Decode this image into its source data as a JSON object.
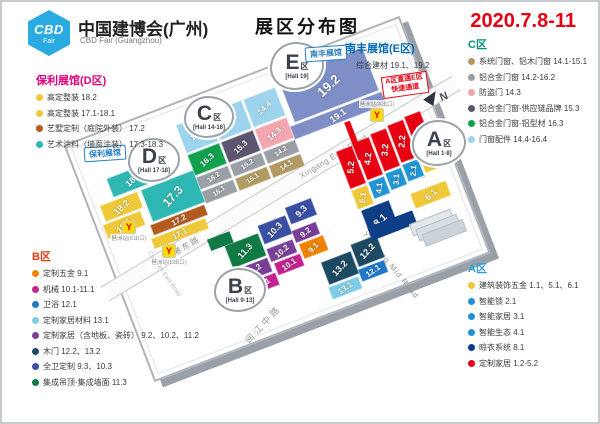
{
  "header": {
    "logo": {
      "line1": "CBD",
      "line2": "Fair"
    },
    "brand_cn": "中国建博会(广州)",
    "brand_en": "CBD Fair (Guangzhou)",
    "page_title": "展区分布图",
    "date": "2020.7.8-11",
    "date_color": "#e60012"
  },
  "legends": {
    "d": {
      "title": "保利展馆(D区)",
      "title_color": "#e5007e",
      "items": [
        {
          "dot": "#f0c93a",
          "label": "高定整装 18.2"
        },
        {
          "dot": "#f0c93a",
          "label": "高定整装 17.1-18.1"
        },
        {
          "dot": "#b35a1f",
          "label": "艺墅定制（庭院外装） 17.2"
        },
        {
          "dot": "#2fb8b3",
          "label": "艺术涂料（墙面涂装） 17.3-18.3"
        }
      ]
    },
    "e": {
      "title": "南丰展馆(E区)",
      "title_color": "#0068b7",
      "items": [
        {
          "dot": "#7e8ec6",
          "label": "综合建材 19.1、19.2"
        }
      ]
    },
    "c": {
      "title": "C区",
      "title_color": "#00917c",
      "items": [
        {
          "dot": "#b39a63",
          "label": "系统门窗、铝木门窗 14.1-15.1"
        },
        {
          "dot": "#9aa0a6",
          "label": "铝合金门窗 14.2-16.2"
        },
        {
          "dot": "#f2a7b0",
          "label": "防盗门 14.3"
        },
        {
          "dot": "#5c5470",
          "label": "铝合金门窗-供应链品牌 15.3"
        },
        {
          "dot": "#12a04e",
          "label": "铝合金门窗-铝型材 16.3"
        },
        {
          "dot": "#9fd4ee",
          "label": "门窗配件 14.4-16.4"
        }
      ]
    },
    "a": {
      "title": "A区",
      "title_color": "#2a9fdc",
      "items": [
        {
          "dot": "#f0c93a",
          "label": "建筑装饰五金 1.1、5.1、6.1"
        },
        {
          "dot": "#1e90d6",
          "label": "智能锁 2.1"
        },
        {
          "dot": "#1e90d6",
          "label": "智能家居 3.1"
        },
        {
          "dot": "#1e90d6",
          "label": "智能生态 4.1"
        },
        {
          "dot": "#0b3c8c",
          "label": "晾衣系统 8.1"
        },
        {
          "dot": "#e60012",
          "label": "定制家居 1.2-5.2"
        }
      ]
    },
    "b": {
      "title": "B区",
      "title_color": "#e8380d",
      "items": [
        {
          "dot": "#ef8200",
          "label": "定制五金 9.1"
        },
        {
          "dot": "#c4228f",
          "label": "机械 10.1-11.1"
        },
        {
          "dot": "#1f78c8",
          "label": "卫浴 12.1"
        },
        {
          "dot": "#7ecde8",
          "label": "定制家居材料 13.1"
        },
        {
          "dot": "#7a3f98",
          "label": "定制家居（含地板、瓷砖） 9.2、10.2、11.2"
        },
        {
          "dot": "#1d4a63",
          "label": "木门 12.2、13.2"
        },
        {
          "dot": "#3a4fa3",
          "label": "全卫定制 9.3、10.3"
        },
        {
          "dot": "#0f7a43",
          "label": "集成吊顶·集成墙面 11.3"
        }
      ]
    }
  },
  "map": {
    "clouds": [
      {
        "id": "e",
        "letter": "E",
        "qu": "区",
        "hall": "[Hall 19]"
      },
      {
        "id": "c",
        "letter": "C",
        "qu": "区",
        "hall": "[Hall 14-16]"
      },
      {
        "id": "d",
        "letter": "D",
        "qu": "区",
        "hall": "[Hall 17-18]"
      },
      {
        "id": "b",
        "letter": "B",
        "qu": "区",
        "hall": "[Hall 9-13]"
      },
      {
        "id": "a",
        "letter": "A",
        "qu": "区",
        "hall": "[Hall 1-8]"
      }
    ],
    "tags": [
      {
        "id": "nanfeng",
        "label": "南丰展馆"
      },
      {
        "id": "poly",
        "label": "保利展馆"
      }
    ],
    "notice": {
      "line1": "A区直通E区",
      "line2": "快速通道"
    },
    "compass": "N",
    "roads": [
      {
        "id": "xingang-cn",
        "label": "新港东路"
      },
      {
        "id": "xingang-en",
        "label": "Xingang East Road"
      },
      {
        "id": "yuejiang-cn",
        "label": "阅江中路"
      },
      {
        "id": "yuejiang-en",
        "label": "Yuejiang Mid Road"
      },
      {
        "id": "complex-west",
        "label": "Complex West Road"
      },
      {
        "id": "complex-east",
        "label": "Complex East Road"
      }
    ],
    "metro_exits": [
      {
        "label": "琶洲站(A出口)"
      },
      {
        "label": "琶洲站(C出口)"
      },
      {
        "label": "琶洲站(D出口)"
      }
    ],
    "halls": [
      {
        "id": "19.2",
        "label": "19.2",
        "color": "#7e8ec6"
      },
      {
        "id": "19.1",
        "label": "19.1",
        "color": "#7e8ec6"
      },
      {
        "id": "16.4",
        "label": "16.4",
        "color": "#9fd4ee"
      },
      {
        "id": "15.4",
        "label": "15.4",
        "color": "#9fd4ee"
      },
      {
        "id": "14.4",
        "label": "14.4",
        "color": "#9fd4ee"
      },
      {
        "id": "16.3",
        "label": "16.3",
        "color": "#12a04e"
      },
      {
        "id": "15.3",
        "label": "15.3",
        "color": "#5c5470"
      },
      {
        "id": "14.3",
        "label": "14.3",
        "color": "#f2a7b0"
      },
      {
        "id": "16.2",
        "label": "16.2",
        "color": "#9aa0a6"
      },
      {
        "id": "15.2",
        "label": "15.2",
        "color": "#9aa0a6"
      },
      {
        "id": "14.2",
        "label": "14.2",
        "color": "#9aa0a6"
      },
      {
        "id": "16.1",
        "label": "16.1",
        "color": "#9aa0a6"
      },
      {
        "id": "15.1",
        "label": "15.1",
        "color": "#b39a63"
      },
      {
        "id": "14.1",
        "label": "14.1",
        "color": "#b39a63"
      },
      {
        "id": "18.3",
        "label": "18.3",
        "color": "#2fb8b3"
      },
      {
        "id": "18.2",
        "label": "18.2",
        "color": "#f0c93a"
      },
      {
        "id": "18.1",
        "label": "18.1",
        "color": "#f0c93a"
      },
      {
        "id": "17.3",
        "label": "17.3",
        "color": "#2fb8b3"
      },
      {
        "id": "17.2",
        "label": "17.2",
        "color": "#b35a1f"
      },
      {
        "id": "17.1",
        "label": "17.1",
        "color": "#f0c93a"
      },
      {
        "id": "5.2",
        "label": "5.2",
        "color": "#e60012"
      },
      {
        "id": "4.2",
        "label": "4.2",
        "color": "#e60012"
      },
      {
        "id": "3.2",
        "label": "3.2",
        "color": "#e60012"
      },
      {
        "id": "2.2",
        "label": "2.2",
        "color": "#e60012"
      },
      {
        "id": "1.2",
        "label": "1.2",
        "color": "#e60012"
      },
      {
        "id": "5.1",
        "label": "5.1",
        "color": "#f0c93a"
      },
      {
        "id": "4.1",
        "label": "4.1",
        "color": "#2196d4"
      },
      {
        "id": "3.1",
        "label": "3.1",
        "color": "#2196d4"
      },
      {
        "id": "2.1",
        "label": "2.1",
        "color": "#2196d4"
      },
      {
        "id": "1.1",
        "label": "1.1",
        "color": "#f0c93a"
      },
      {
        "id": "6.1",
        "label": "6.1",
        "color": "#f0c93a"
      },
      {
        "id": "8.1",
        "label": "8.1",
        "color": "#0e3f86"
      },
      {
        "id": "11.3",
        "label": "11.3",
        "color": "#0f7a43"
      },
      {
        "id": "10.3",
        "label": "10.3",
        "color": "#3a4fa3"
      },
      {
        "id": "9.3",
        "label": "9.3",
        "color": "#3a4fa3"
      },
      {
        "id": "11.2",
        "label": "11.2",
        "color": "#7a3f98"
      },
      {
        "id": "10.2",
        "label": "10.2",
        "color": "#7a3f98"
      },
      {
        "id": "9.2",
        "label": "9.2",
        "color": "#7a3f98"
      },
      {
        "id": "11.1",
        "label": "11.1",
        "color": "#c4228f"
      },
      {
        "id": "10.1",
        "label": "10.1",
        "color": "#c4228f"
      },
      {
        "id": "9.1",
        "label": "9.1",
        "color": "#ef8200"
      },
      {
        "id": "13.2",
        "label": "13.2",
        "color": "#1d4a63"
      },
      {
        "id": "12.2",
        "label": "12.2",
        "color": "#1d4a63"
      },
      {
        "id": "13.1",
        "label": "13.1",
        "color": "#7ecde8"
      },
      {
        "id": "12.1",
        "label": "12.1",
        "color": "#1f78c8"
      }
    ]
  }
}
